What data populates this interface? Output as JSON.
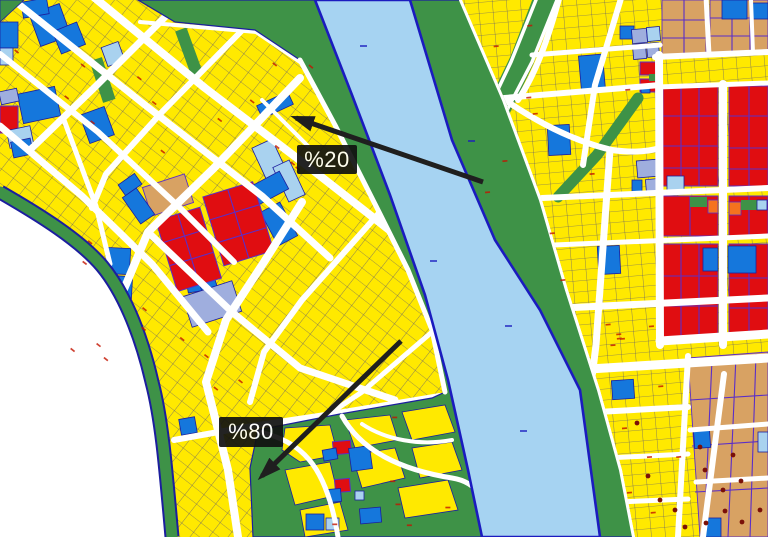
{
  "map": {
    "annotations": [
      {
        "id": "pct20",
        "label": "%20"
      },
      {
        "id": "pct80",
        "label": "%80"
      }
    ],
    "palette": {
      "parcel_yellow": "#FFE900",
      "park_green": "#3E9247",
      "water_blue": "#A6D3F2",
      "water_border": "#1B1BBF",
      "parcel_line_navy": "#1C1E9E",
      "zone_blue": "#1577DC",
      "zone_sky": "#A9D2EF",
      "zone_periwinkle": "#9FAEDE",
      "zone_tan": "#D8A263",
      "zone_orange": "#F5731E",
      "zone_red": "#E00D11",
      "block_line_purple": "#5A2EC8",
      "road_white": "#FFFFFF",
      "dot_darkred": "#7A1008",
      "label_marker_red": "#C41400",
      "arrow_black": "#1F1F1F",
      "label_bg": "#111111",
      "label_text": "#FFFFFF"
    }
  }
}
